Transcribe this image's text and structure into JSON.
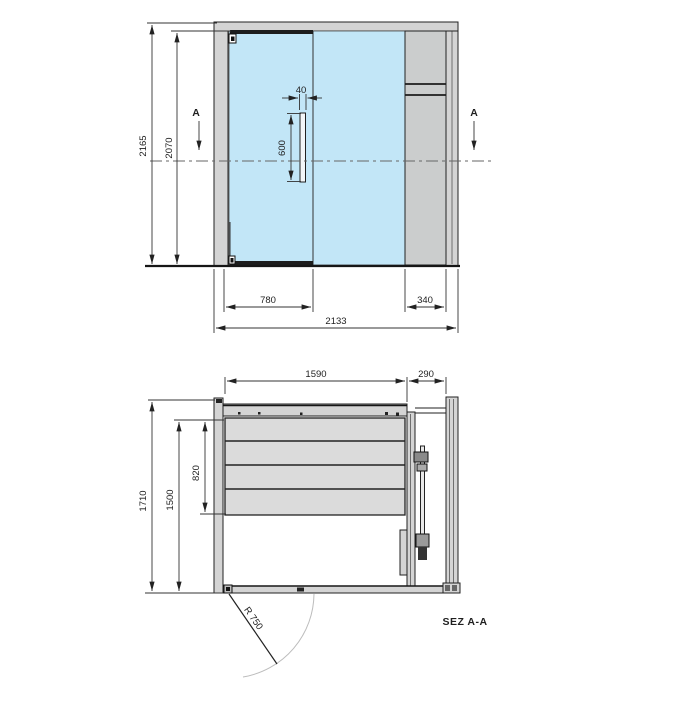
{
  "drawing": {
    "section_marker": "A",
    "colors": {
      "glass": "#c2e6f7",
      "frame": "#d4d4d4",
      "panel": "#cbcdcd",
      "bench": "#dbdbdb",
      "dark_fitting": "#1d1d1d",
      "dim_line": "#333333",
      "swing_arc": "#bcbcbc"
    },
    "elevation": {
      "dim_total_height": "2165",
      "dim_door_height": "2070",
      "dim_handle_width": "40",
      "dim_handle_length": "600",
      "dim_door_width": "780",
      "dim_side_panel_width": "340",
      "dim_total_width": "2133"
    },
    "plan": {
      "dim_interior_width": "1590",
      "dim_heater_zone_width": "290",
      "dim_total_depth": "1710",
      "dim_interior_depth": "1500",
      "dim_bench_depth": "820",
      "door_swing_radius_label": "R 750",
      "section_title": "SEZ A-A"
    }
  }
}
